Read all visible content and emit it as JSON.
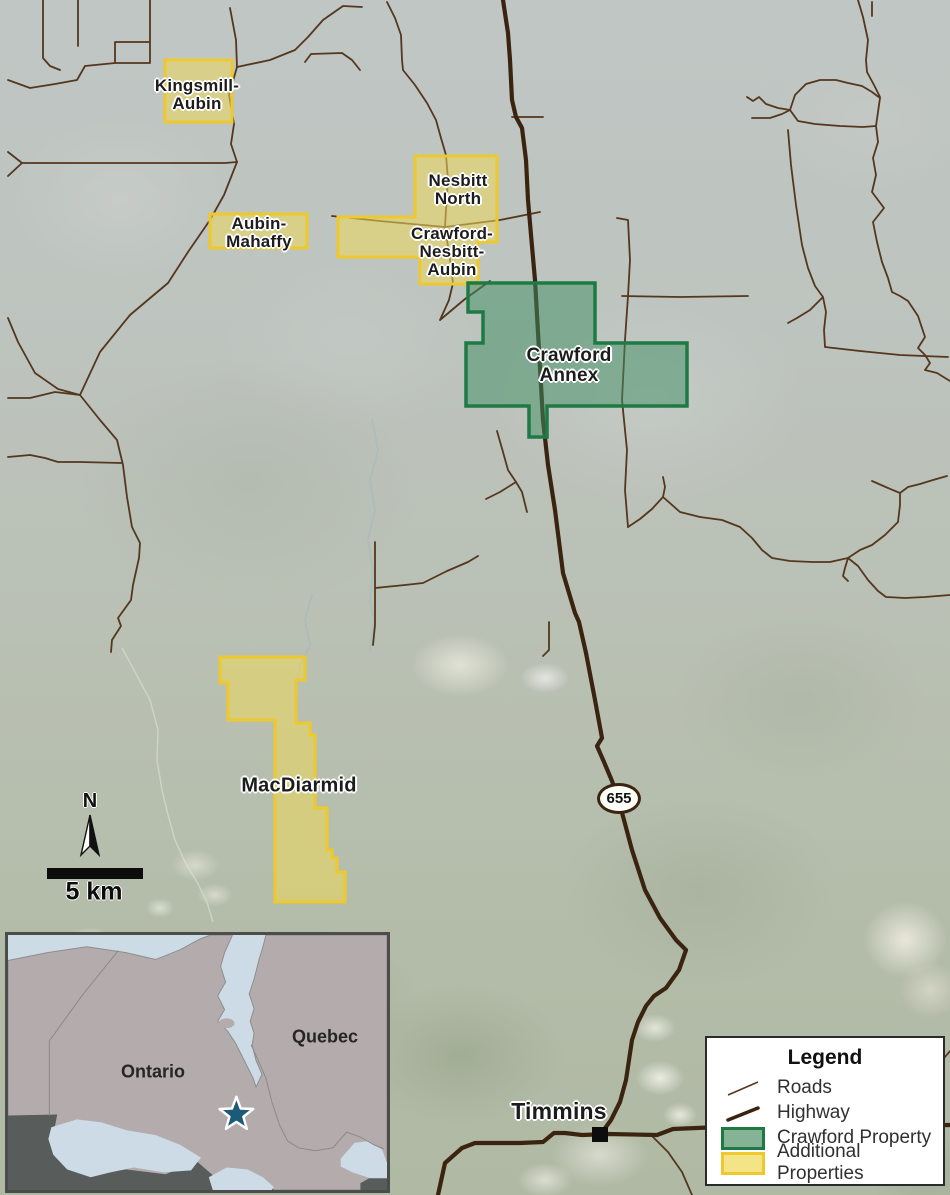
{
  "map_title": "Crawford Property and Additional Properties location map, Timmins area",
  "properties": [
    {
      "name": "Kingsmill-Aubin",
      "type": "additional"
    },
    {
      "name": "Aubin-Mahaffy",
      "type": "additional"
    },
    {
      "name": "Nesbitt North",
      "type": "additional"
    },
    {
      "name": "Crawford-Nesbitt-Aubin",
      "type": "additional"
    },
    {
      "name": "Crawford Annex",
      "type": "crawford"
    },
    {
      "name": "MacDiarmid",
      "type": "additional"
    }
  ],
  "labels": {
    "kingsmill": {
      "line1": "Kingsmill-",
      "line2": "Aubin"
    },
    "aubin_mahaffy": {
      "line1": "Aubin-",
      "line2": "Mahaffy"
    },
    "nesbitt_north": {
      "line1": "Nesbitt",
      "line2": "North"
    },
    "crawford_nesbitt_aubin": {
      "line1": "Crawford-",
      "line2": "Nesbitt-",
      "line3": "Aubin"
    },
    "crawford_annex": {
      "line1": "Crawford",
      "line2": "Annex"
    },
    "macdiarmid": {
      "text": "MacDiarmid"
    },
    "timmins": {
      "text": "Timmins"
    }
  },
  "highway_shield": {
    "number": "655"
  },
  "north_arrow": {
    "label": "N"
  },
  "scale_bar": {
    "label": "5 km"
  },
  "inset": {
    "ontario_label": "Ontario",
    "quebec_label": "Quebec"
  },
  "legend": {
    "title": "Legend",
    "items": [
      {
        "label": "Roads",
        "symbol": "road-line"
      },
      {
        "label": "Highway",
        "symbol": "highway-line"
      },
      {
        "label": "Crawford Property",
        "symbol": "green-swatch"
      },
      {
        "label": "Additional Properties",
        "symbol": "yellow-swatch"
      }
    ]
  },
  "colors": {
    "crawford_property_fill": "#3f8f63",
    "crawford_property_border": "#1e7a45",
    "additional_property_fill": "#ecd95b",
    "additional_property_border": "#eec92d",
    "highway": "#3a2410",
    "roads": "#54371e",
    "inset_water": "#cddbe7",
    "inset_land": "#b4acac",
    "inset_dark_land": "#585d5b",
    "location_star": "#1d5a78"
  }
}
